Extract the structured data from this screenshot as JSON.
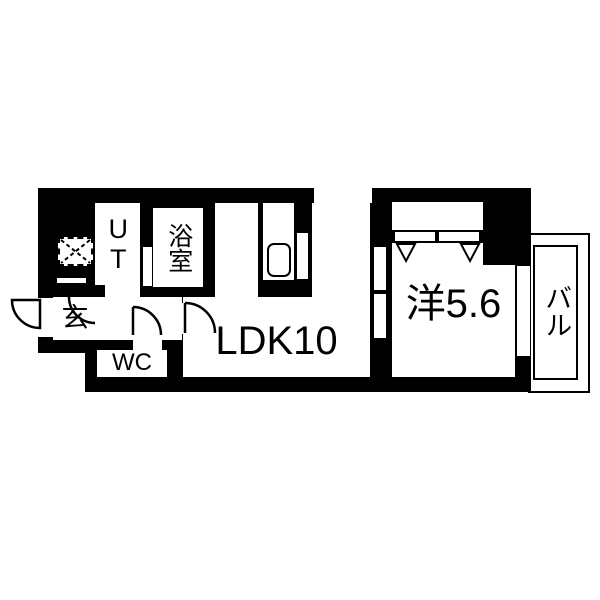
{
  "meta": {
    "title": "apartment-floor-plan",
    "background_color": "#ffffff",
    "wall_color": "#000000",
    "line_color": "#000000"
  },
  "rooms": {
    "ut": {
      "label": "UT"
    },
    "bath": {
      "label": "浴室"
    },
    "entrance": {
      "label": "玄"
    },
    "wc": {
      "label": "WC"
    },
    "ldk": {
      "label": "LDK10"
    },
    "bedroom": {
      "label": "洋5.6"
    },
    "balcony": {
      "label": "バル"
    }
  },
  "fixtures": {
    "meter_box": "dashed-box-with-x",
    "kitchen_sink": "rounded-sink-basin",
    "entrance_door": "outward-swing-arc",
    "wc_door": "inward-swing-arc",
    "ldk_door": "inward-swing-arc",
    "ut_door": "swing-arc",
    "bedroom_ldk_door": "two-panel-sliding-door",
    "closet_marks": "two-down-triangles",
    "windows": [
      "top-wall-window",
      "bedroom-balcony-window"
    ]
  }
}
